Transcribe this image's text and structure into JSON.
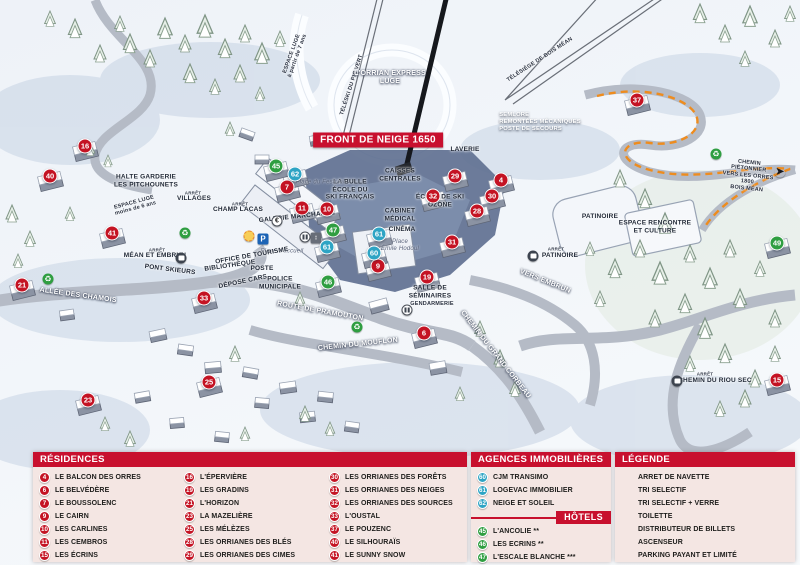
{
  "colors": {
    "header_red": "#c8102e",
    "marker_red": "#c41323",
    "marker_blue": "#2ea4c4",
    "marker_green": "#2f9e41",
    "panel_bg": "#f4e6e3",
    "piste_orange": "#ee8c1e"
  },
  "map": {
    "banner": "FRONT DE NEIGE 1650",
    "markers": [
      {
        "n": "16",
        "type": "red",
        "x": 85,
        "y": 146
      },
      {
        "n": "40",
        "type": "red",
        "x": 50,
        "y": 176
      },
      {
        "n": "41",
        "type": "red",
        "x": 112,
        "y": 233
      },
      {
        "n": "21",
        "type": "red",
        "x": 22,
        "y": 285
      },
      {
        "n": "33",
        "type": "red",
        "x": 204,
        "y": 298
      },
      {
        "n": "23",
        "type": "red",
        "x": 88,
        "y": 400
      },
      {
        "n": "25",
        "type": "red",
        "x": 209,
        "y": 382
      },
      {
        "n": "7",
        "type": "red",
        "x": 287,
        "y": 187
      },
      {
        "n": "11",
        "type": "red",
        "x": 302,
        "y": 208
      },
      {
        "n": "10",
        "type": "red",
        "x": 327,
        "y": 209
      },
      {
        "n": "9",
        "type": "red",
        "x": 378,
        "y": 266
      },
      {
        "n": "31",
        "type": "red",
        "x": 452,
        "y": 242
      },
      {
        "n": "19",
        "type": "red",
        "x": 427,
        "y": 277
      },
      {
        "n": "6",
        "type": "red",
        "x": 424,
        "y": 333
      },
      {
        "n": "32",
        "type": "red",
        "x": 433,
        "y": 196
      },
      {
        "n": "29",
        "type": "red",
        "x": 455,
        "y": 176
      },
      {
        "n": "4",
        "type": "red",
        "x": 501,
        "y": 180
      },
      {
        "n": "30",
        "type": "red",
        "x": 492,
        "y": 196
      },
      {
        "n": "28",
        "type": "red",
        "x": 477,
        "y": 211
      },
      {
        "n": "37",
        "type": "red",
        "x": 637,
        "y": 100
      },
      {
        "n": "15",
        "type": "red",
        "x": 777,
        "y": 380
      },
      {
        "n": "62",
        "type": "blue",
        "x": 295,
        "y": 174
      },
      {
        "n": "61",
        "type": "blue",
        "x": 327,
        "y": 247
      },
      {
        "n": "61",
        "type": "blue",
        "x": 379,
        "y": 234
      },
      {
        "n": "60",
        "type": "blue",
        "x": 374,
        "y": 253
      },
      {
        "n": "45",
        "type": "green",
        "x": 276,
        "y": 166
      },
      {
        "n": "47",
        "type": "green",
        "x": 333,
        "y": 230
      },
      {
        "n": "46",
        "type": "green",
        "x": 328,
        "y": 282
      },
      {
        "n": "49",
        "type": "green",
        "x": 777,
        "y": 243
      }
    ],
    "labels": [
      {
        "t": "ESPACE LUGE\nà partir de 7 ans",
        "x": 295,
        "y": 55,
        "r": -70,
        "c": "ds"
      },
      {
        "t": "TÉLÉSKI DU PIC VERT",
        "x": 352,
        "y": 85,
        "r": -72,
        "c": "ds"
      },
      {
        "t": "L'ORRIAN EXPRESS\nLUGE",
        "x": 390,
        "y": 78,
        "r": 0,
        "c": "w"
      },
      {
        "t": "TÉLÉSIÈGE DE BOIS MÉAN",
        "x": 540,
        "y": 60,
        "r": -33,
        "c": "ds"
      },
      {
        "t": "SEMLORE\nREMONTÉES MÉCANIQUES\nPOSTE DE SECOURS",
        "x": 540,
        "y": 122,
        "r": 0,
        "c": "wl"
      },
      {
        "t": "LAVERIE",
        "x": 465,
        "y": 150,
        "r": 0,
        "c": "d"
      },
      {
        "t": "CAISSES\nCENTRALES",
        "x": 400,
        "y": 175,
        "r": 0,
        "c": "d"
      },
      {
        "t": "LA BULLE\nÉCOLE DU\nSKI FRANÇAIS",
        "x": 350,
        "y": 190,
        "r": 0,
        "c": "d"
      },
      {
        "t": "ÉCOLE DE SKI\nOZONE",
        "x": 440,
        "y": 201,
        "r": 0,
        "c": "d"
      },
      {
        "t": "CABINET\nMÉDICAL",
        "x": 400,
        "y": 215,
        "r": 0,
        "c": "d"
      },
      {
        "t": "CINÉMA",
        "x": 402,
        "y": 230,
        "r": 0,
        "c": "d"
      },
      {
        "t": "Place\nÉmile Hodoul",
        "x": 400,
        "y": 246,
        "r": 0,
        "c": "i"
      },
      {
        "t": "Place du Festival",
        "x": 320,
        "y": 183,
        "r": 0,
        "c": "i"
      },
      {
        "t": "Place d'accueil",
        "x": 282,
        "y": 252,
        "r": 0,
        "c": "i"
      },
      {
        "t": "GALERIE MARCHANDE",
        "x": 297,
        "y": 217,
        "r": -6,
        "c": "d"
      },
      {
        "t": "OFFICE DE TOURISME",
        "x": 252,
        "y": 256,
        "r": -10,
        "c": "d"
      },
      {
        "t": "BIBLIOTHÈQUE",
        "x": 230,
        "y": 266,
        "r": -8,
        "c": "d"
      },
      {
        "t": "POSTE",
        "x": 262,
        "y": 269,
        "r": 0,
        "c": "d"
      },
      {
        "t": "DÉPOSE CARS",
        "x": 243,
        "y": 282,
        "r": -12,
        "c": "d"
      },
      {
        "t": "POLICE\nMUNICIPALE",
        "x": 280,
        "y": 283,
        "r": 0,
        "c": "d"
      },
      {
        "t": "SALLE DE\nSÉMINAIRES",
        "x": 430,
        "y": 292,
        "r": 0,
        "c": "d"
      },
      {
        "t": "GENDARMERIE",
        "x": 432,
        "y": 304,
        "r": 0,
        "c": "ds"
      },
      {
        "t": "HALTE GARDERIE\nLES PITCHOUNETS",
        "x": 146,
        "y": 181,
        "r": 0,
        "c": "d"
      },
      {
        "t": "ARRÊT",
        "x": 193,
        "y": 193,
        "r": 0,
        "c": "a"
      },
      {
        "t": "VILLAGES",
        "x": 194,
        "y": 199,
        "r": 0,
        "c": "d"
      },
      {
        "t": "ARRÊT",
        "x": 240,
        "y": 204,
        "r": 0,
        "c": "a"
      },
      {
        "t": "CHAMP LACAS",
        "x": 238,
        "y": 210,
        "r": 0,
        "c": "d"
      },
      {
        "t": "ARRÊT",
        "x": 157,
        "y": 250,
        "r": 0,
        "c": "a"
      },
      {
        "t": "MÉAN ET EMBRUN",
        "x": 155,
        "y": 256,
        "r": 0,
        "c": "d"
      },
      {
        "t": "PONT SKIEURS",
        "x": 170,
        "y": 270,
        "r": 7,
        "c": "d"
      },
      {
        "t": "ARRÊT",
        "x": 556,
        "y": 249,
        "r": 0,
        "c": "a"
      },
      {
        "t": "PATINOIRE",
        "x": 560,
        "y": 256,
        "r": 0,
        "c": "d"
      },
      {
        "t": "PATINOIRE",
        "x": 600,
        "y": 217,
        "r": 0,
        "c": "d"
      },
      {
        "t": "ESPACE RENCONTRE\nET CULTURE",
        "x": 655,
        "y": 227,
        "r": 0,
        "c": "d"
      },
      {
        "t": "ARRÊT",
        "x": 705,
        "y": 374,
        "r": 0,
        "c": "a"
      },
      {
        "t": "CHEMIN DU RIOU SEC",
        "x": 715,
        "y": 381,
        "r": 0,
        "c": "d"
      },
      {
        "t": "ALLÉE DES CHAMOIS",
        "x": 78,
        "y": 296,
        "r": 8,
        "c": "w"
      },
      {
        "t": "ROUTE DE PRAMOUTON",
        "x": 320,
        "y": 312,
        "r": 10,
        "c": "w"
      },
      {
        "t": "CHEMIN DU MOUFLON",
        "x": 358,
        "y": 345,
        "r": -6,
        "c": "w"
      },
      {
        "t": "CHEMIN DU GRAND CORBEAU",
        "x": 495,
        "y": 355,
        "r": 52,
        "c": "w"
      },
      {
        "t": "VERS EMBRUN",
        "x": 545,
        "y": 282,
        "r": 22,
        "c": "w"
      },
      {
        "t": "CHEMIN PIÉTONNIER\nVERS LES ORRES 1800\nBOIS MÉAN",
        "x": 748,
        "y": 176,
        "r": 6,
        "c": "ds"
      },
      {
        "t": "ESPACE LUGE\nmoins de 6 ans",
        "x": 135,
        "y": 206,
        "r": -15,
        "c": "ds"
      }
    ],
    "icons": [
      {
        "k": "recycle",
        "x": 185,
        "y": 233
      },
      {
        "k": "recycle",
        "x": 48,
        "y": 279
      },
      {
        "k": "recycle",
        "x": 357,
        "y": 327
      },
      {
        "k": "recycle",
        "x": 716,
        "y": 154
      },
      {
        "k": "euro",
        "x": 277,
        "y": 221
      },
      {
        "k": "parking",
        "x": 263,
        "y": 239
      },
      {
        "k": "glass",
        "x": 249,
        "y": 236
      },
      {
        "k": "wc",
        "x": 305,
        "y": 237
      },
      {
        "k": "elevator",
        "x": 316,
        "y": 238
      },
      {
        "k": "wc",
        "x": 407,
        "y": 310
      },
      {
        "k": "bus",
        "x": 181,
        "y": 258
      },
      {
        "k": "bus",
        "x": 533,
        "y": 256
      },
      {
        "k": "bus",
        "x": 677,
        "y": 381
      },
      {
        "k": "arrow-right",
        "x": 780,
        "y": 172
      }
    ]
  },
  "panels": {
    "residences": {
      "title": "RÉSIDENCES",
      "items": [
        {
          "n": "4",
          "label": "LE BALCON DES ORRES"
        },
        {
          "n": "6",
          "label": "LE BELVÉDÈRE"
        },
        {
          "n": "7",
          "label": "LE BOUSSOLENC"
        },
        {
          "n": "9",
          "label": "LE CAIRN"
        },
        {
          "n": "10",
          "label": "LES CARLINES"
        },
        {
          "n": "11",
          "label": "LES CEMBROS"
        },
        {
          "n": "15",
          "label": "LES ÉCRINS"
        },
        {
          "n": "16",
          "label": "L'ÉPERVIÈRE"
        },
        {
          "n": "19",
          "label": "LES GRADINS"
        },
        {
          "n": "21",
          "label": "L'HORIZON"
        },
        {
          "n": "23",
          "label": "LA MAZELIÈRE"
        },
        {
          "n": "25",
          "label": "LES MÉLÈZES"
        },
        {
          "n": "28",
          "label": "LES ORRIANES DES BLÉS"
        },
        {
          "n": "29",
          "label": "LES ORRIANES DES CIMES"
        },
        {
          "n": "30",
          "label": "LES ORRIANES DES FORÊTS"
        },
        {
          "n": "31",
          "label": "LES ORRIANES DES NEIGES"
        },
        {
          "n": "32",
          "label": "LES ORRIANES DES SOURCES"
        },
        {
          "n": "33",
          "label": "L'OUSTAL"
        },
        {
          "n": "37",
          "label": "LE POUZENC"
        },
        {
          "n": "40",
          "label": "LE SILHOURAÏS"
        },
        {
          "n": "41",
          "label": "LE SUNNY SNOW"
        }
      ]
    },
    "agences": {
      "title": "AGENCES IMMOBILIÈRES",
      "items": [
        {
          "n": "60",
          "label": "CJM TRANSIMO"
        },
        {
          "n": "61",
          "label": "LOGEVAC IMMOBILIER"
        },
        {
          "n": "62",
          "label": "NEIGE ET SOLEIL"
        }
      ]
    },
    "hotels": {
      "title": "HÔTELS",
      "items": [
        {
          "n": "45",
          "label": "L'ANCOLIE **"
        },
        {
          "n": "46",
          "label": "LES ECRINS **"
        },
        {
          "n": "47",
          "label": "L'ESCALE BLANCHE ***"
        },
        {
          "n": "49",
          "label": "LES TRAPPEURS **"
        }
      ]
    },
    "legende": {
      "title": "LÉGENDE",
      "items": [
        {
          "icon": "bus",
          "label": "ARRET DE NAVETTE"
        },
        {
          "icon": "recycle",
          "label": "TRI SELECTIF"
        },
        {
          "icon": "glass",
          "label": "TRI SELECTIF + VERRE"
        },
        {
          "icon": "wc",
          "label": "TOILETTE"
        },
        {
          "icon": "euro",
          "label": "DISTRIBUTEUR DE BILLETS"
        },
        {
          "icon": "elevator",
          "label": "ASCENSEUR"
        },
        {
          "icon": "parking",
          "label": "PARKING PAYANT ET LIMITÉ"
        }
      ]
    }
  }
}
